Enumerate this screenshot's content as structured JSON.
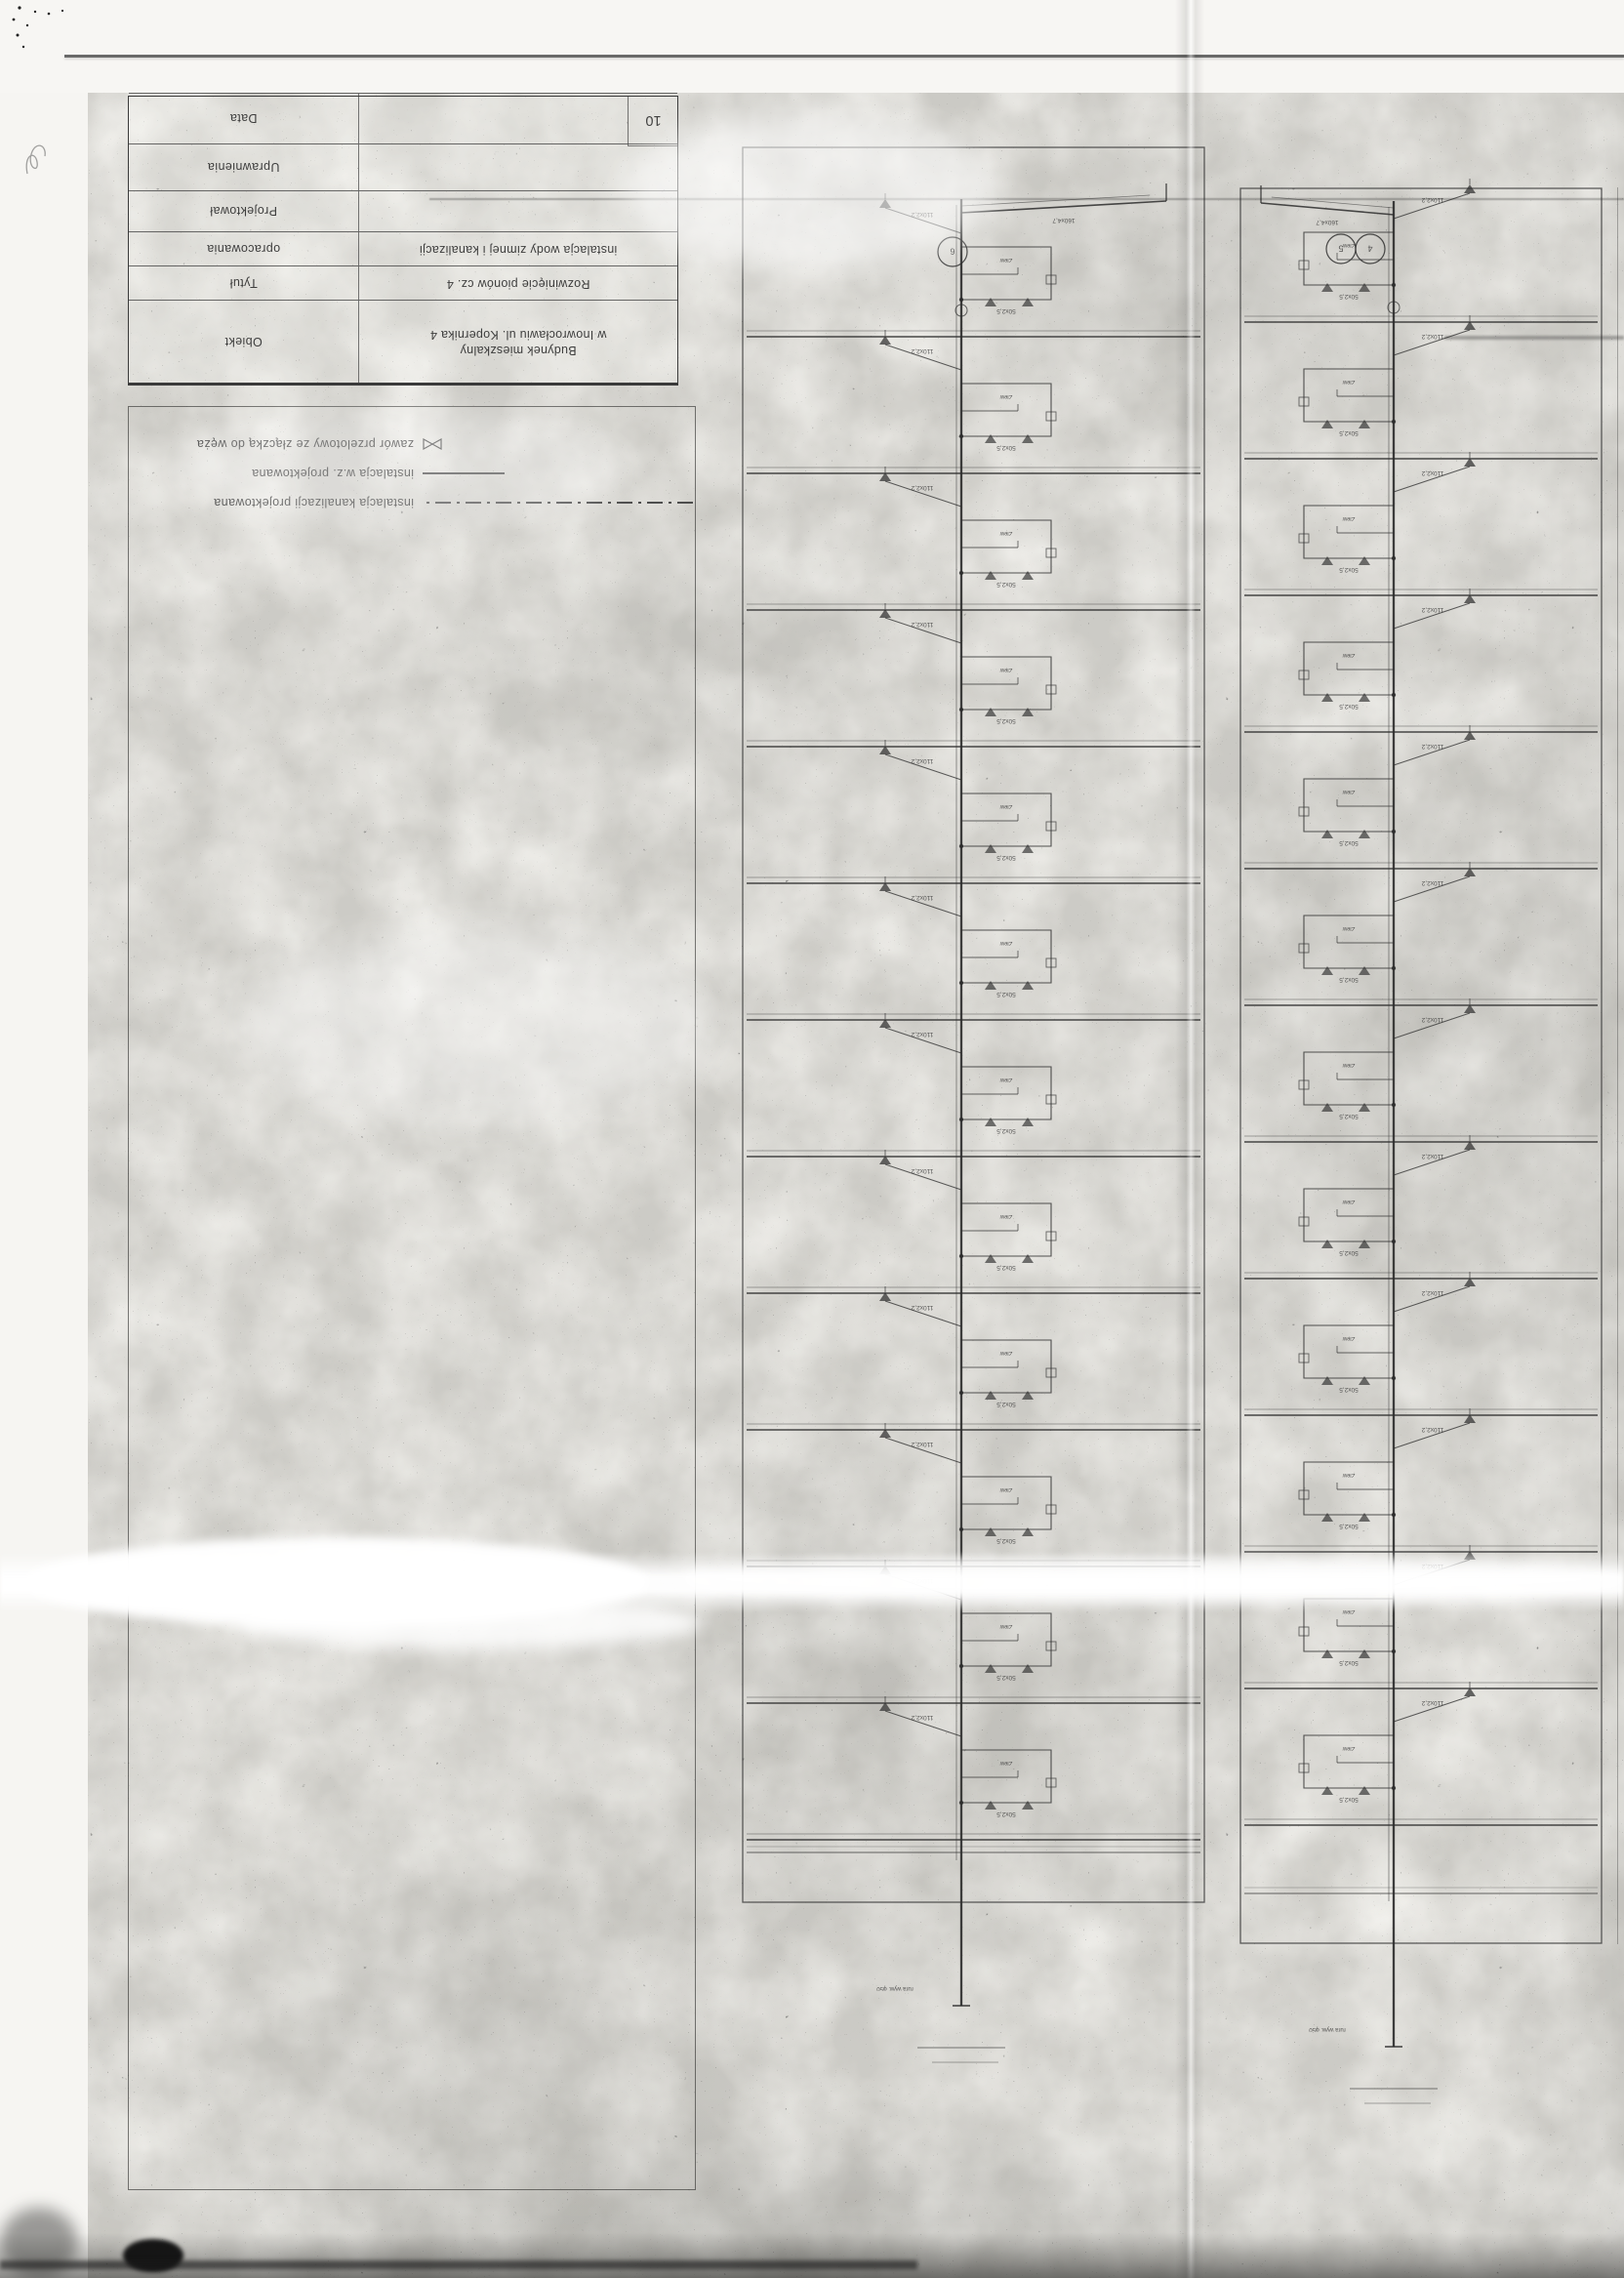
{
  "sheet": {
    "page_number": "10",
    "title_block": {
      "rows": [
        {
          "label": "Obiekt",
          "value": "Budynek mieszkalny\nw Inowrocławiu ul. Kopernika 4"
        },
        {
          "label": "Tytuł",
          "value": "Rozwinięcie pionów cz. 4"
        },
        {
          "label": "opracowania",
          "value": "instalacja wody zimnej i kanalizacji"
        },
        {
          "label": "Projektował",
          "value": ""
        },
        {
          "label": "Uprawnienia",
          "value": ""
        },
        {
          "label": "Data",
          "value": ""
        }
      ]
    },
    "legend": {
      "items": [
        {
          "style": "dashdot",
          "label": "instalacja kanalizacji projektowana"
        },
        {
          "style": "solid",
          "label": "instalacja w.z. projektowana"
        },
        {
          "style": "valve",
          "label": "zawór przelotowy ze złączką do węża"
        }
      ]
    },
    "risers": {
      "panel_a": {
        "circles": [
          "6"
        ],
        "floors": 12
      },
      "panel_b": {
        "circles": [
          "4",
          "5"
        ],
        "floors": 12
      }
    },
    "riser_labels": {
      "branch": "50x2,5",
      "stack": "110x2,2",
      "fixture": "Zlew",
      "basement": "160x4,7",
      "vent": "rura wyw. φ50"
    },
    "colors": {
      "ink": "#2b2b2b",
      "paper": "#f2f1ed"
    }
  }
}
